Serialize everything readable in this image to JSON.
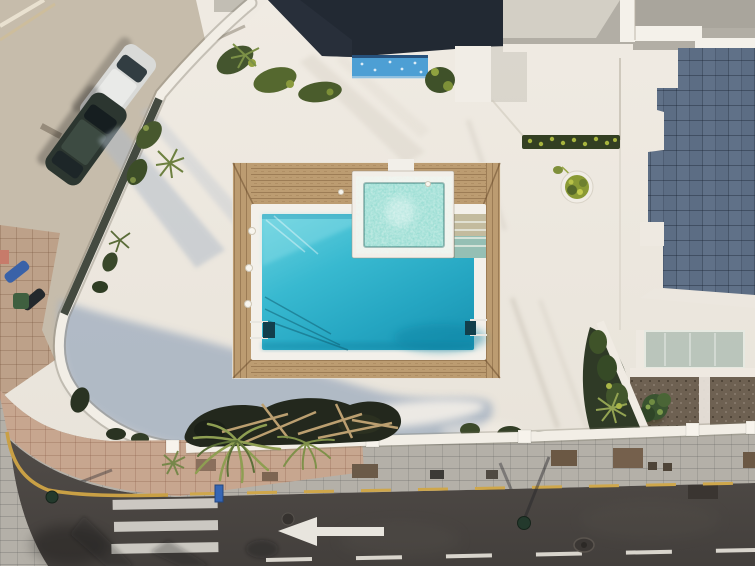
{
  "scene": {
    "description": "Aerial drone view of a white Mediterranean villa terrace with a turquoise swimming pool and bubbling spa framed by a wooden deck, curved white perimeter walls with planters, two cars parked on the street at top left, grey tiled villa roof at right, and an asphalt road with a white left-pointing lane arrow and zebra crosswalk at the bottom",
    "pool": {
      "shape": "rectangular",
      "spa_attached": true,
      "ladders": 2,
      "deck_material": "wood"
    },
    "street": {
      "parked_cars": 2,
      "mopeds": 2,
      "crosswalk_stripes": 3,
      "arrow_direction": "left"
    }
  },
  "palette": {
    "patio": "#ebe6de",
    "patio_shadow": "#a7b3c2",
    "wood": "#bc9c71",
    "coping": "#f3f0ea",
    "pool_water": "#2fb3cb",
    "spa_water": "#82d4c9",
    "wall_white": "#f2eee6",
    "roof_dark": "#222933",
    "roof_tiles": "#5c6d84",
    "roof_flat": "#b2aea5",
    "glass_canopy": "#b7c3b9",
    "plant_dark": "#2f3a26",
    "plant_light": "#93a352",
    "street_concrete": "#c6bcab",
    "sidewalk_pink": "#c7a68f",
    "sidewalk_gray": "#b4b0a8",
    "road": "#4b4743",
    "marking_white": "#e8e5de",
    "marking_yellow": "#c9a045",
    "water_feature": "#4d9fd4",
    "car_silver": "#d9dad8",
    "car_dark": "#2c3630",
    "courtyard": "#6e6152",
    "bed_soil": "#23281d"
  }
}
